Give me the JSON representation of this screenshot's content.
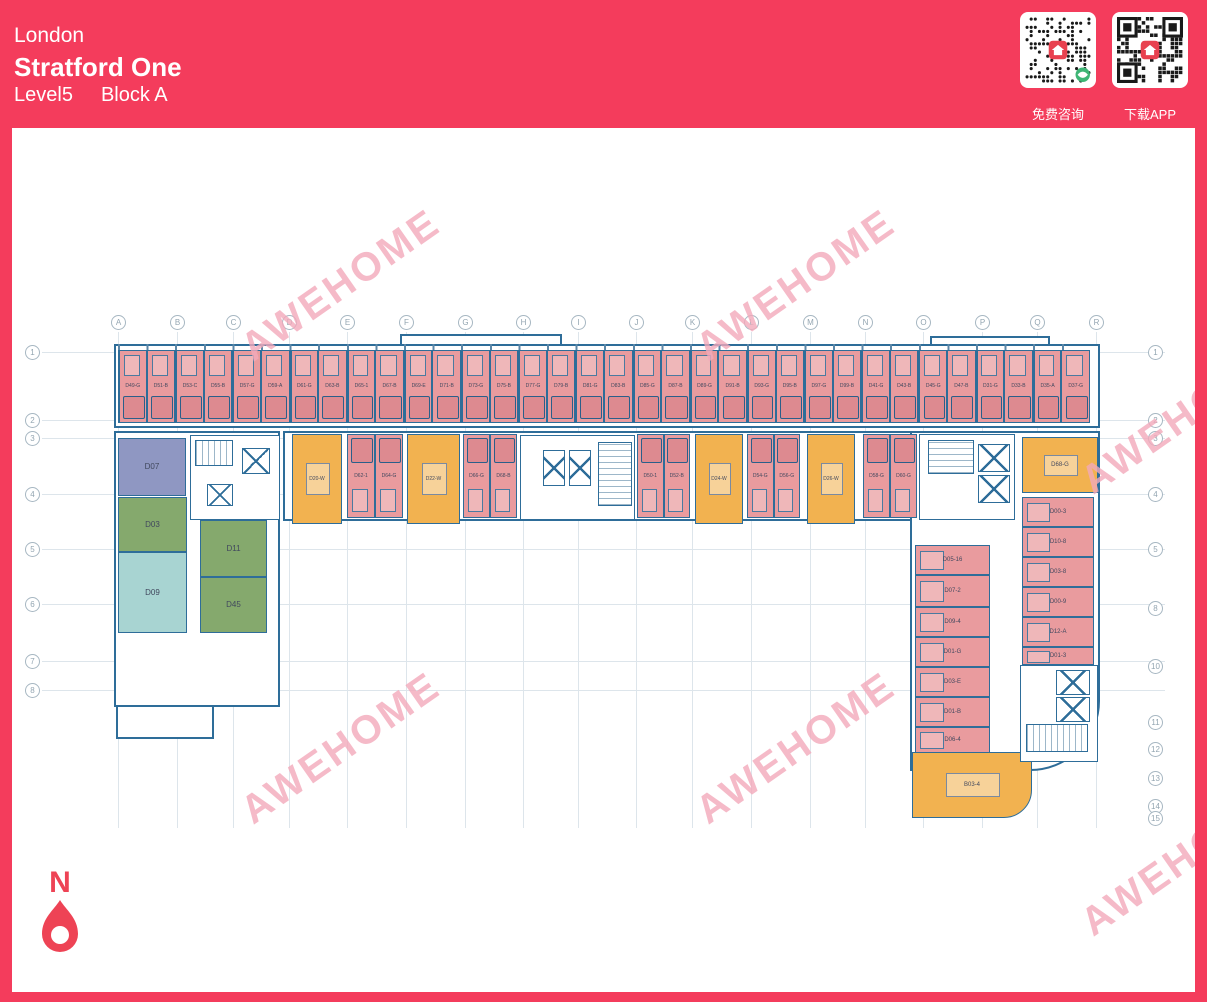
{
  "header": {
    "city": "London",
    "project": "Stratford One",
    "level": "Level5",
    "block": "Block A"
  },
  "qr": {
    "left_label": "免费咨询",
    "right_label": "下载APP"
  },
  "compass": {
    "label": "N"
  },
  "watermark": {
    "text": "AWEHOME",
    "positions": [
      {
        "x": 345,
        "y": 287
      },
      {
        "x": 800,
        "y": 287
      },
      {
        "x": 345,
        "y": 750
      },
      {
        "x": 800,
        "y": 750
      },
      {
        "x": 1185,
        "y": 420
      },
      {
        "x": 1185,
        "y": 862
      }
    ]
  },
  "colors": {
    "brand_red": "#f43c5c",
    "room_pink": "#e99b9e",
    "room_orange": "#f2b250",
    "room_purple": "#8f97c2",
    "room_green": "#85a96d",
    "room_teal": "#a8d4d2",
    "plan_line": "#2e6d99",
    "watermark_pink": "#f3aabb"
  },
  "grid": {
    "columns": [
      {
        "label": "A",
        "x": 118
      },
      {
        "label": "B",
        "x": 177
      },
      {
        "label": "C",
        "x": 233
      },
      {
        "label": "D",
        "x": 289
      },
      {
        "label": "E",
        "x": 347
      },
      {
        "label": "F",
        "x": 406
      },
      {
        "label": "G",
        "x": 465
      },
      {
        "label": "H",
        "x": 523
      },
      {
        "label": "I",
        "x": 578
      },
      {
        "label": "J",
        "x": 636
      },
      {
        "label": "K",
        "x": 692
      },
      {
        "label": "L",
        "x": 751
      },
      {
        "label": "M",
        "x": 810
      },
      {
        "label": "N",
        "x": 865
      },
      {
        "label": "O",
        "x": 923
      },
      {
        "label": "P",
        "x": 982
      },
      {
        "label": "Q",
        "x": 1037
      },
      {
        "label": "R",
        "x": 1096
      }
    ],
    "rows_left": [
      {
        "label": "1",
        "y": 352
      },
      {
        "label": "2",
        "y": 420
      },
      {
        "label": "3",
        "y": 438
      },
      {
        "label": "4",
        "y": 494
      },
      {
        "label": "5",
        "y": 549
      },
      {
        "label": "6",
        "y": 604
      },
      {
        "label": "7",
        "y": 661
      },
      {
        "label": "8",
        "y": 690
      }
    ],
    "rows_right": [
      {
        "label": "1",
        "y": 352
      },
      {
        "label": "2",
        "y": 420
      },
      {
        "label": "3",
        "y": 438
      },
      {
        "label": "4",
        "y": 494
      },
      {
        "label": "5",
        "y": 549
      },
      {
        "label": "8",
        "y": 608
      },
      {
        "label": "10",
        "y": 666
      },
      {
        "label": "11",
        "y": 722
      },
      {
        "label": "12",
        "y": 749
      },
      {
        "label": "13",
        "y": 778
      },
      {
        "label": "14",
        "y": 806
      },
      {
        "label": "15",
        "y": 818
      }
    ]
  },
  "plan": {
    "top_row": {
      "x0": 118,
      "y": 350,
      "unit_w": 28.588,
      "h": 73,
      "labels": [
        "D49-G",
        "D51-B",
        "D53-C",
        "D55-B",
        "D57-G",
        "D59-A",
        "D61-G",
        "D63-B",
        "D65-1",
        "D67-B",
        "D69-E",
        "D71-B",
        "D73-G",
        "D75-B",
        "D77-G",
        "D79-B",
        "D81-G",
        "D83-B",
        "D85-G",
        "D87-B",
        "D89-G",
        "D91-B",
        "D93-G",
        "D95-B",
        "D97-G",
        "D99-B",
        "D41-G",
        "D43-B",
        "D45-G",
        "D47-B",
        "D31-G",
        "D33-B",
        "D35-A",
        "D37-G"
      ]
    },
    "row2": {
      "y": 434,
      "h": 84,
      "segments": [
        {
          "type": "kitchen",
          "x": 292,
          "w": 50,
          "label": "D20-W"
        },
        {
          "type": "pair",
          "x": 347,
          "w": 56,
          "labels": [
            "D62-1",
            "D64-G"
          ]
        },
        {
          "type": "kitchen",
          "x": 407,
          "w": 53,
          "label": "D22-W"
        },
        {
          "type": "pair",
          "x": 463,
          "w": 54,
          "labels": [
            "D66-G",
            "D68-B"
          ]
        },
        {
          "type": "pair",
          "x": 637,
          "w": 53,
          "labels": [
            "D50-1",
            "D52-B"
          ]
        },
        {
          "type": "kitchen",
          "x": 695,
          "w": 48,
          "label": "D24-W"
        },
        {
          "type": "pair",
          "x": 747,
          "w": 53,
          "labels": [
            "D54-G",
            "D56-G"
          ]
        },
        {
          "type": "kitchen",
          "x": 807,
          "w": 48,
          "label": "D26-W"
        },
        {
          "type": "pair",
          "x": 863,
          "w": 54,
          "labels": [
            "D58-G",
            "D60-G"
          ]
        }
      ]
    },
    "left_wing": [
      {
        "label": "D07",
        "color": "purple",
        "x": 118,
        "y": 438,
        "w": 68,
        "h": 58
      },
      {
        "label": "D03",
        "color": "green",
        "x": 118,
        "y": 497,
        "w": 69,
        "h": 55
      },
      {
        "label": "D09",
        "color": "teal",
        "x": 118,
        "y": 552,
        "w": 69,
        "h": 81
      },
      {
        "label": "D11",
        "color": "green",
        "x": 200,
        "y": 520,
        "w": 67,
        "h": 57
      },
      {
        "label": "D45",
        "color": "green",
        "x": 200,
        "y": 577,
        "w": 67,
        "h": 56
      }
    ],
    "right_wing": {
      "kitchen_top": {
        "label": "D68-G",
        "x": 1022,
        "y": 437,
        "w": 76,
        "h": 56
      },
      "kitchen_bottom": {
        "label": "B03-4",
        "x": 912,
        "y": 752,
        "w": 120,
        "h": 66
      },
      "left_col": [
        {
          "label": "D05-16",
          "x": 915,
          "y": 545,
          "w": 75,
          "h": 30
        },
        {
          "label": "D07-2",
          "x": 915,
          "y": 575,
          "w": 75,
          "h": 32
        },
        {
          "label": "D09-4",
          "x": 915,
          "y": 607,
          "w": 75,
          "h": 30
        },
        {
          "label": "D01-G",
          "x": 915,
          "y": 637,
          "w": 75,
          "h": 30
        },
        {
          "label": "D03-E",
          "x": 915,
          "y": 667,
          "w": 75,
          "h": 30
        },
        {
          "label": "D01-B",
          "x": 915,
          "y": 697,
          "w": 75,
          "h": 30
        },
        {
          "label": "D06-4",
          "x": 915,
          "y": 727,
          "w": 75,
          "h": 26
        }
      ],
      "right_col": [
        {
          "label": "D00-3",
          "x": 1022,
          "y": 497,
          "w": 72,
          "h": 30
        },
        {
          "label": "D10-8",
          "x": 1022,
          "y": 527,
          "w": 72,
          "h": 30
        },
        {
          "label": "D03-8",
          "x": 1022,
          "y": 557,
          "w": 72,
          "h": 30
        },
        {
          "label": "D00-9",
          "x": 1022,
          "y": 587,
          "w": 72,
          "h": 30
        },
        {
          "label": "D12-A",
          "x": 1022,
          "y": 617,
          "w": 72,
          "h": 30
        },
        {
          "label": "D01-3",
          "x": 1022,
          "y": 647,
          "w": 72,
          "h": 18
        }
      ]
    },
    "outlines": [
      {
        "x": 114,
        "y": 344,
        "w": 986,
        "h": 84
      },
      {
        "x": 400,
        "y": 334,
        "w": 162,
        "h": 12
      },
      {
        "x": 930,
        "y": 336,
        "w": 120,
        "h": 10
      },
      {
        "x": 283,
        "y": 431,
        "w": 817,
        "h": 90
      },
      {
        "x": 114,
        "y": 431,
        "w": 166,
        "h": 276
      },
      {
        "x": 116,
        "y": 705,
        "w": 98,
        "h": 34
      },
      {
        "x": 910,
        "y": 431,
        "w": 190,
        "h": 340,
        "br": 70
      }
    ],
    "cores": [
      {
        "x": 190,
        "y": 435,
        "w": 90,
        "h": 85,
        "items": [
          {
            "kind": "stair",
            "dir": "h",
            "x": 195,
            "y": 440,
            "w": 38,
            "h": 26
          },
          {
            "kind": "lift",
            "x": 242,
            "y": 448,
            "w": 28,
            "h": 26
          },
          {
            "kind": "lift",
            "x": 207,
            "y": 484,
            "w": 26,
            "h": 22
          }
        ]
      },
      {
        "x": 520,
        "y": 435,
        "w": 115,
        "h": 85,
        "items": [
          {
            "kind": "lift",
            "x": 543,
            "y": 450,
            "w": 22,
            "h": 36
          },
          {
            "kind": "lift",
            "x": 569,
            "y": 450,
            "w": 22,
            "h": 36
          },
          {
            "kind": "stair",
            "dir": "v",
            "x": 598,
            "y": 442,
            "w": 34,
            "h": 64
          }
        ]
      },
      {
        "x": 919,
        "y": 434,
        "w": 96,
        "h": 86,
        "items": [
          {
            "kind": "stair",
            "dir": "v",
            "x": 928,
            "y": 440,
            "w": 46,
            "h": 34
          },
          {
            "kind": "lift",
            "x": 978,
            "y": 444,
            "w": 32,
            "h": 28
          },
          {
            "kind": "lift",
            "x": 978,
            "y": 475,
            "w": 32,
            "h": 28
          }
        ]
      },
      {
        "x": 1020,
        "y": 665,
        "w": 78,
        "h": 97,
        "items": [
          {
            "kind": "lift",
            "x": 1056,
            "y": 670,
            "w": 34,
            "h": 25
          },
          {
            "kind": "lift",
            "x": 1056,
            "y": 697,
            "w": 34,
            "h": 25
          },
          {
            "kind": "stair",
            "dir": "h",
            "x": 1026,
            "y": 724,
            "w": 62,
            "h": 28
          }
        ]
      }
    ]
  }
}
